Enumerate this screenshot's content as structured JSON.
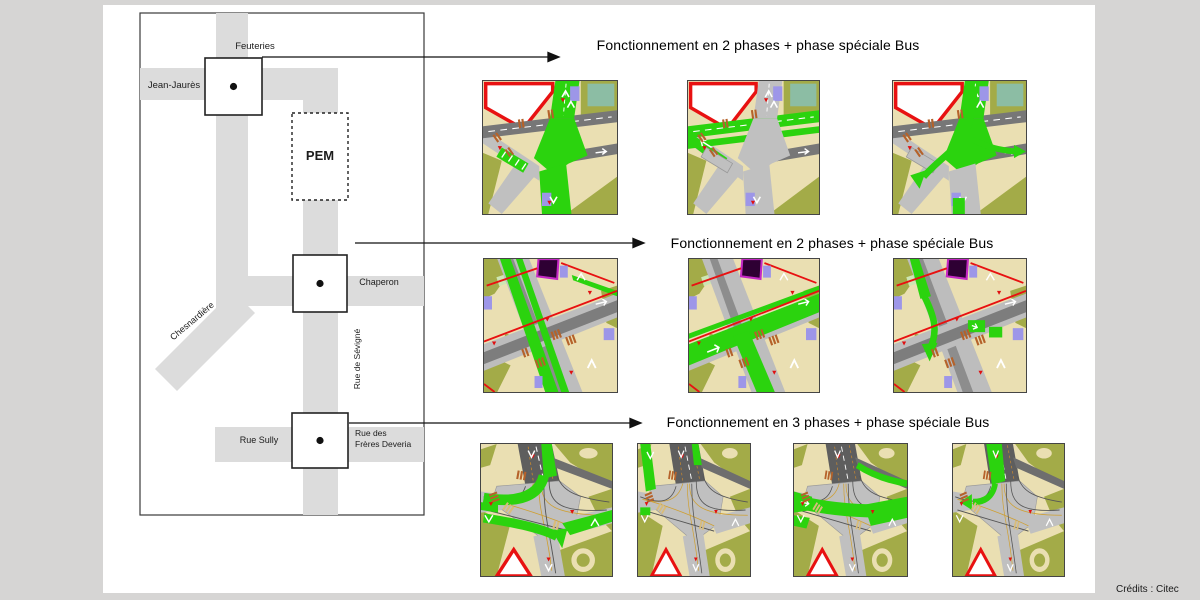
{
  "canvas": {
    "credits": "Crédits : Citec"
  },
  "map": {
    "streets": {
      "feuteries": "Feuteries",
      "jean_jaures": "Jean-Jaurès",
      "pem": "PEM",
      "chaperon": "Chaperon",
      "chesnardiere": "Chesnardière",
      "sevigne": "Rue de Sévigné",
      "rue_sully": "Rue Sully",
      "deveria1": "Rue des",
      "deveria2": "Frères Deveria"
    }
  },
  "rows": [
    {
      "title": "Fonctionnement en 2 phases + phase spéciale Bus",
      "tiles": [
        {
          "type": "A",
          "name": "phase-1",
          "green": [
            "ns"
          ]
        },
        {
          "type": "A",
          "name": "phase-2",
          "green": [
            "ew"
          ]
        },
        {
          "type": "A",
          "name": "phase-bus",
          "green": [
            "bus"
          ]
        }
      ]
    },
    {
      "title": "Fonctionnement en 2 phases + phase spéciale Bus",
      "tiles": [
        {
          "type": "B",
          "name": "phase-1",
          "green": [
            "ns"
          ]
        },
        {
          "type": "B",
          "name": "phase-2",
          "green": [
            "ew"
          ]
        },
        {
          "type": "B",
          "name": "phase-bus",
          "green": [
            "bus"
          ]
        }
      ]
    },
    {
      "title": "Fonctionnement en 3 phases + phase spéciale Bus",
      "tiles": [
        {
          "type": "C",
          "name": "phase-1",
          "green": [
            "p1"
          ]
        },
        {
          "type": "C",
          "name": "phase-2",
          "green": [
            "p2"
          ]
        },
        {
          "type": "C",
          "name": "phase-3",
          "green": [
            "p3"
          ]
        },
        {
          "type": "C",
          "name": "phase-bus",
          "green": [
            "bus"
          ]
        }
      ]
    }
  ],
  "colors": {
    "page_bg": "#d6d5d4",
    "panel_bg": "#ffffff",
    "map_road": "#dcdcdc",
    "green": "#2bd30e",
    "road_light": "#c0c0c0",
    "asphalt": "#777777",
    "beige": "#eadfb2",
    "olive": "#a3ab48",
    "teal": "#8cbda4",
    "bus_purple": "#9d96e8",
    "signal_orange": "#b5622a",
    "red": "#e81111",
    "dark_purple": "#2e0033",
    "magenta": "#c428c4",
    "yellow": "#f2e33c"
  }
}
